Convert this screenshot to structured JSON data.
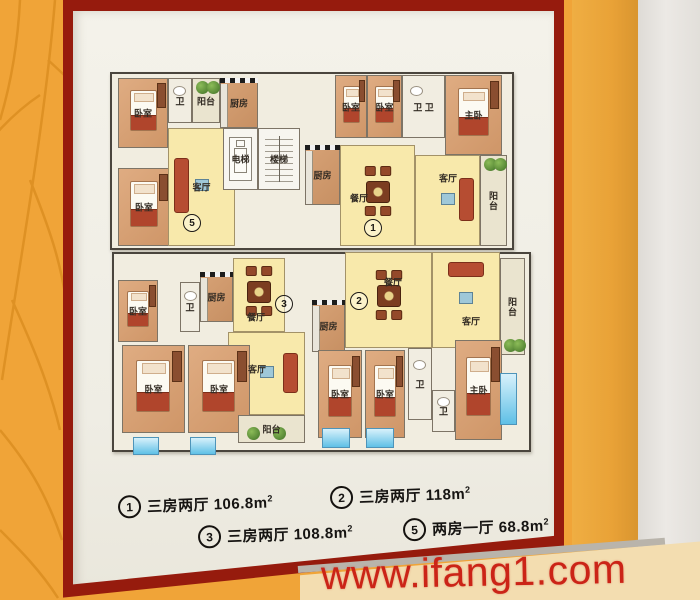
{
  "watermark": {
    "text": "www.ifang1.com"
  },
  "legend": {
    "items": [
      {
        "num": "1",
        "type_label": "三房两厅",
        "area": "106.8m",
        "sup": "2",
        "x": 118,
        "y": 493
      },
      {
        "num": "2",
        "type_label": "三房两厅",
        "area": "118m",
        "sup": "2",
        "x": 330,
        "y": 484
      },
      {
        "num": "3",
        "type_label": "三房两厅",
        "area": "108.8m",
        "sup": "2",
        "x": 198,
        "y": 523
      },
      {
        "num": "5",
        "type_label": "两房一厅",
        "area": "68.8m",
        "sup": "2",
        "x": 403,
        "y": 516
      }
    ]
  },
  "plan": {
    "plates": [
      {
        "x": 10,
        "y": 12,
        "w": 400,
        "h": 174
      },
      {
        "x": 12,
        "y": 192,
        "w": 415,
        "h": 196
      }
    ],
    "rooms": [
      {
        "label": "卧室",
        "type": "bedroom",
        "x": 18,
        "y": 18,
        "w": 50,
        "h": 70
      },
      {
        "label": "卫",
        "type": "bath",
        "x": 68,
        "y": 18,
        "w": 24,
        "h": 45
      },
      {
        "label": "阳台",
        "type": "balcony",
        "x": 92,
        "y": 18,
        "w": 28,
        "h": 45,
        "plants": "top"
      },
      {
        "label": "厨房",
        "type": "kitchen",
        "x": 120,
        "y": 18,
        "w": 38,
        "h": 50
      },
      {
        "label": "卧室",
        "type": "bedroom",
        "x": 18,
        "y": 108,
        "w": 52,
        "h": 78
      },
      {
        "label": "客厅",
        "type": "living",
        "x": 68,
        "y": 68,
        "w": 67,
        "h": 118,
        "sofa": "left"
      },
      {
        "label": "电梯",
        "type": "elevator",
        "x": 123,
        "y": 68,
        "w": 35,
        "h": 62
      },
      {
        "label": "楼梯",
        "type": "stairs",
        "x": 158,
        "y": 68,
        "w": 42,
        "h": 62
      },
      {
        "label": "卧室",
        "type": "bedroom",
        "x": 235,
        "y": 15,
        "w": 32,
        "h": 63
      },
      {
        "label": "卧室",
        "type": "bedroom",
        "x": 267,
        "y": 15,
        "w": 35,
        "h": 63
      },
      {
        "label": "卫 卫",
        "type": "bath",
        "x": 302,
        "y": 15,
        "w": 43,
        "h": 63
      },
      {
        "label": "主卧",
        "type": "bedroom",
        "x": 345,
        "y": 15,
        "w": 57,
        "h": 80
      },
      {
        "label": "厨房",
        "type": "kitchen",
        "x": 205,
        "y": 85,
        "w": 35,
        "h": 60
      },
      {
        "label": "餐厅",
        "type": "dining",
        "x": 240,
        "y": 85,
        "w": 75,
        "h": 101,
        "lx": 18,
        "ly": 52
      },
      {
        "label": "客厅",
        "type": "living",
        "x": 315,
        "y": 95,
        "w": 65,
        "h": 91,
        "lx": 32,
        "ly": 22,
        "sofa": "right"
      },
      {
        "label": "阳台",
        "type": "balcony",
        "x": 380,
        "y": 95,
        "w": 27,
        "h": 91,
        "vertical": true,
        "plants": "top"
      },
      {
        "label": "卧室",
        "type": "bedroom",
        "x": 18,
        "y": 220,
        "w": 40,
        "h": 62
      },
      {
        "label": "卫",
        "type": "bath",
        "x": 80,
        "y": 222,
        "w": 20,
        "h": 50
      },
      {
        "label": "厨房",
        "type": "kitchen",
        "x": 100,
        "y": 212,
        "w": 33,
        "h": 50
      },
      {
        "label": "餐厅",
        "type": "dining",
        "x": 133,
        "y": 198,
        "w": 52,
        "h": 74,
        "lx": 22,
        "ly": 58
      },
      {
        "label": "客厅",
        "type": "living",
        "x": 128,
        "y": 272,
        "w": 77,
        "h": 83,
        "lx": 28,
        "ly": 36,
        "sofa": "right"
      },
      {
        "label": "卧室",
        "type": "bedroom",
        "x": 22,
        "y": 285,
        "w": 63,
        "h": 88
      },
      {
        "label": "卧室",
        "type": "bedroom",
        "x": 88,
        "y": 285,
        "w": 62,
        "h": 88
      },
      {
        "label": "阳台",
        "type": "balcony",
        "x": 138,
        "y": 355,
        "w": 67,
        "h": 28,
        "plants": "bottom"
      },
      {
        "label": "厨房",
        "type": "kitchen",
        "x": 212,
        "y": 240,
        "w": 33,
        "h": 52
      },
      {
        "label": "餐厅",
        "type": "dining",
        "x": 245,
        "y": 192,
        "w": 87,
        "h": 96,
        "lx": 47,
        "ly": 29
      },
      {
        "label": "客厅",
        "type": "living",
        "x": 332,
        "y": 192,
        "w": 68,
        "h": 96,
        "lx": 38,
        "ly": 68,
        "sofa": "top"
      },
      {
        "label": "阳台",
        "type": "balcony",
        "x": 400,
        "y": 198,
        "w": 25,
        "h": 97,
        "vertical": true,
        "plants": "bottom"
      },
      {
        "label": "卧室",
        "type": "bedroom",
        "x": 218,
        "y": 290,
        "w": 44,
        "h": 88
      },
      {
        "label": "卧室",
        "type": "bedroom",
        "x": 265,
        "y": 290,
        "w": 40,
        "h": 88
      },
      {
        "label": "卫",
        "type": "bath",
        "x": 308,
        "y": 288,
        "w": 24,
        "h": 72
      },
      {
        "label": "卫",
        "type": "bath",
        "x": 332,
        "y": 330,
        "w": 23,
        "h": 42
      },
      {
        "label": "主卧",
        "type": "bedroom",
        "x": 355,
        "y": 280,
        "w": 47,
        "h": 100
      }
    ],
    "unit_markers": [
      {
        "num": "5",
        "x": 92,
        "y": 163
      },
      {
        "num": "1",
        "x": 273,
        "y": 168
      },
      {
        "num": "3",
        "x": 184,
        "y": 244
      },
      {
        "num": "2",
        "x": 259,
        "y": 241
      }
    ],
    "windows": [
      {
        "x": 33,
        "y": 377,
        "w": 24,
        "h": 16
      },
      {
        "x": 90,
        "y": 377,
        "w": 24,
        "h": 16
      },
      {
        "x": 222,
        "y": 368,
        "w": 26,
        "h": 18
      },
      {
        "x": 266,
        "y": 368,
        "w": 26,
        "h": 18
      },
      {
        "x": 400,
        "y": 313,
        "w": 15,
        "h": 50
      }
    ]
  },
  "colors": {
    "wall": "#f0a438",
    "frame": "#961b0d",
    "poster": "#f1efe7",
    "hall_yellow": "#f8e9ab",
    "bedroom_tan": "#d8a176",
    "window_blue": "#7fc9e8",
    "watermark_red": "#cb2417",
    "legend_ink": "#161412",
    "beige_panel": "#f3ddb0"
  }
}
